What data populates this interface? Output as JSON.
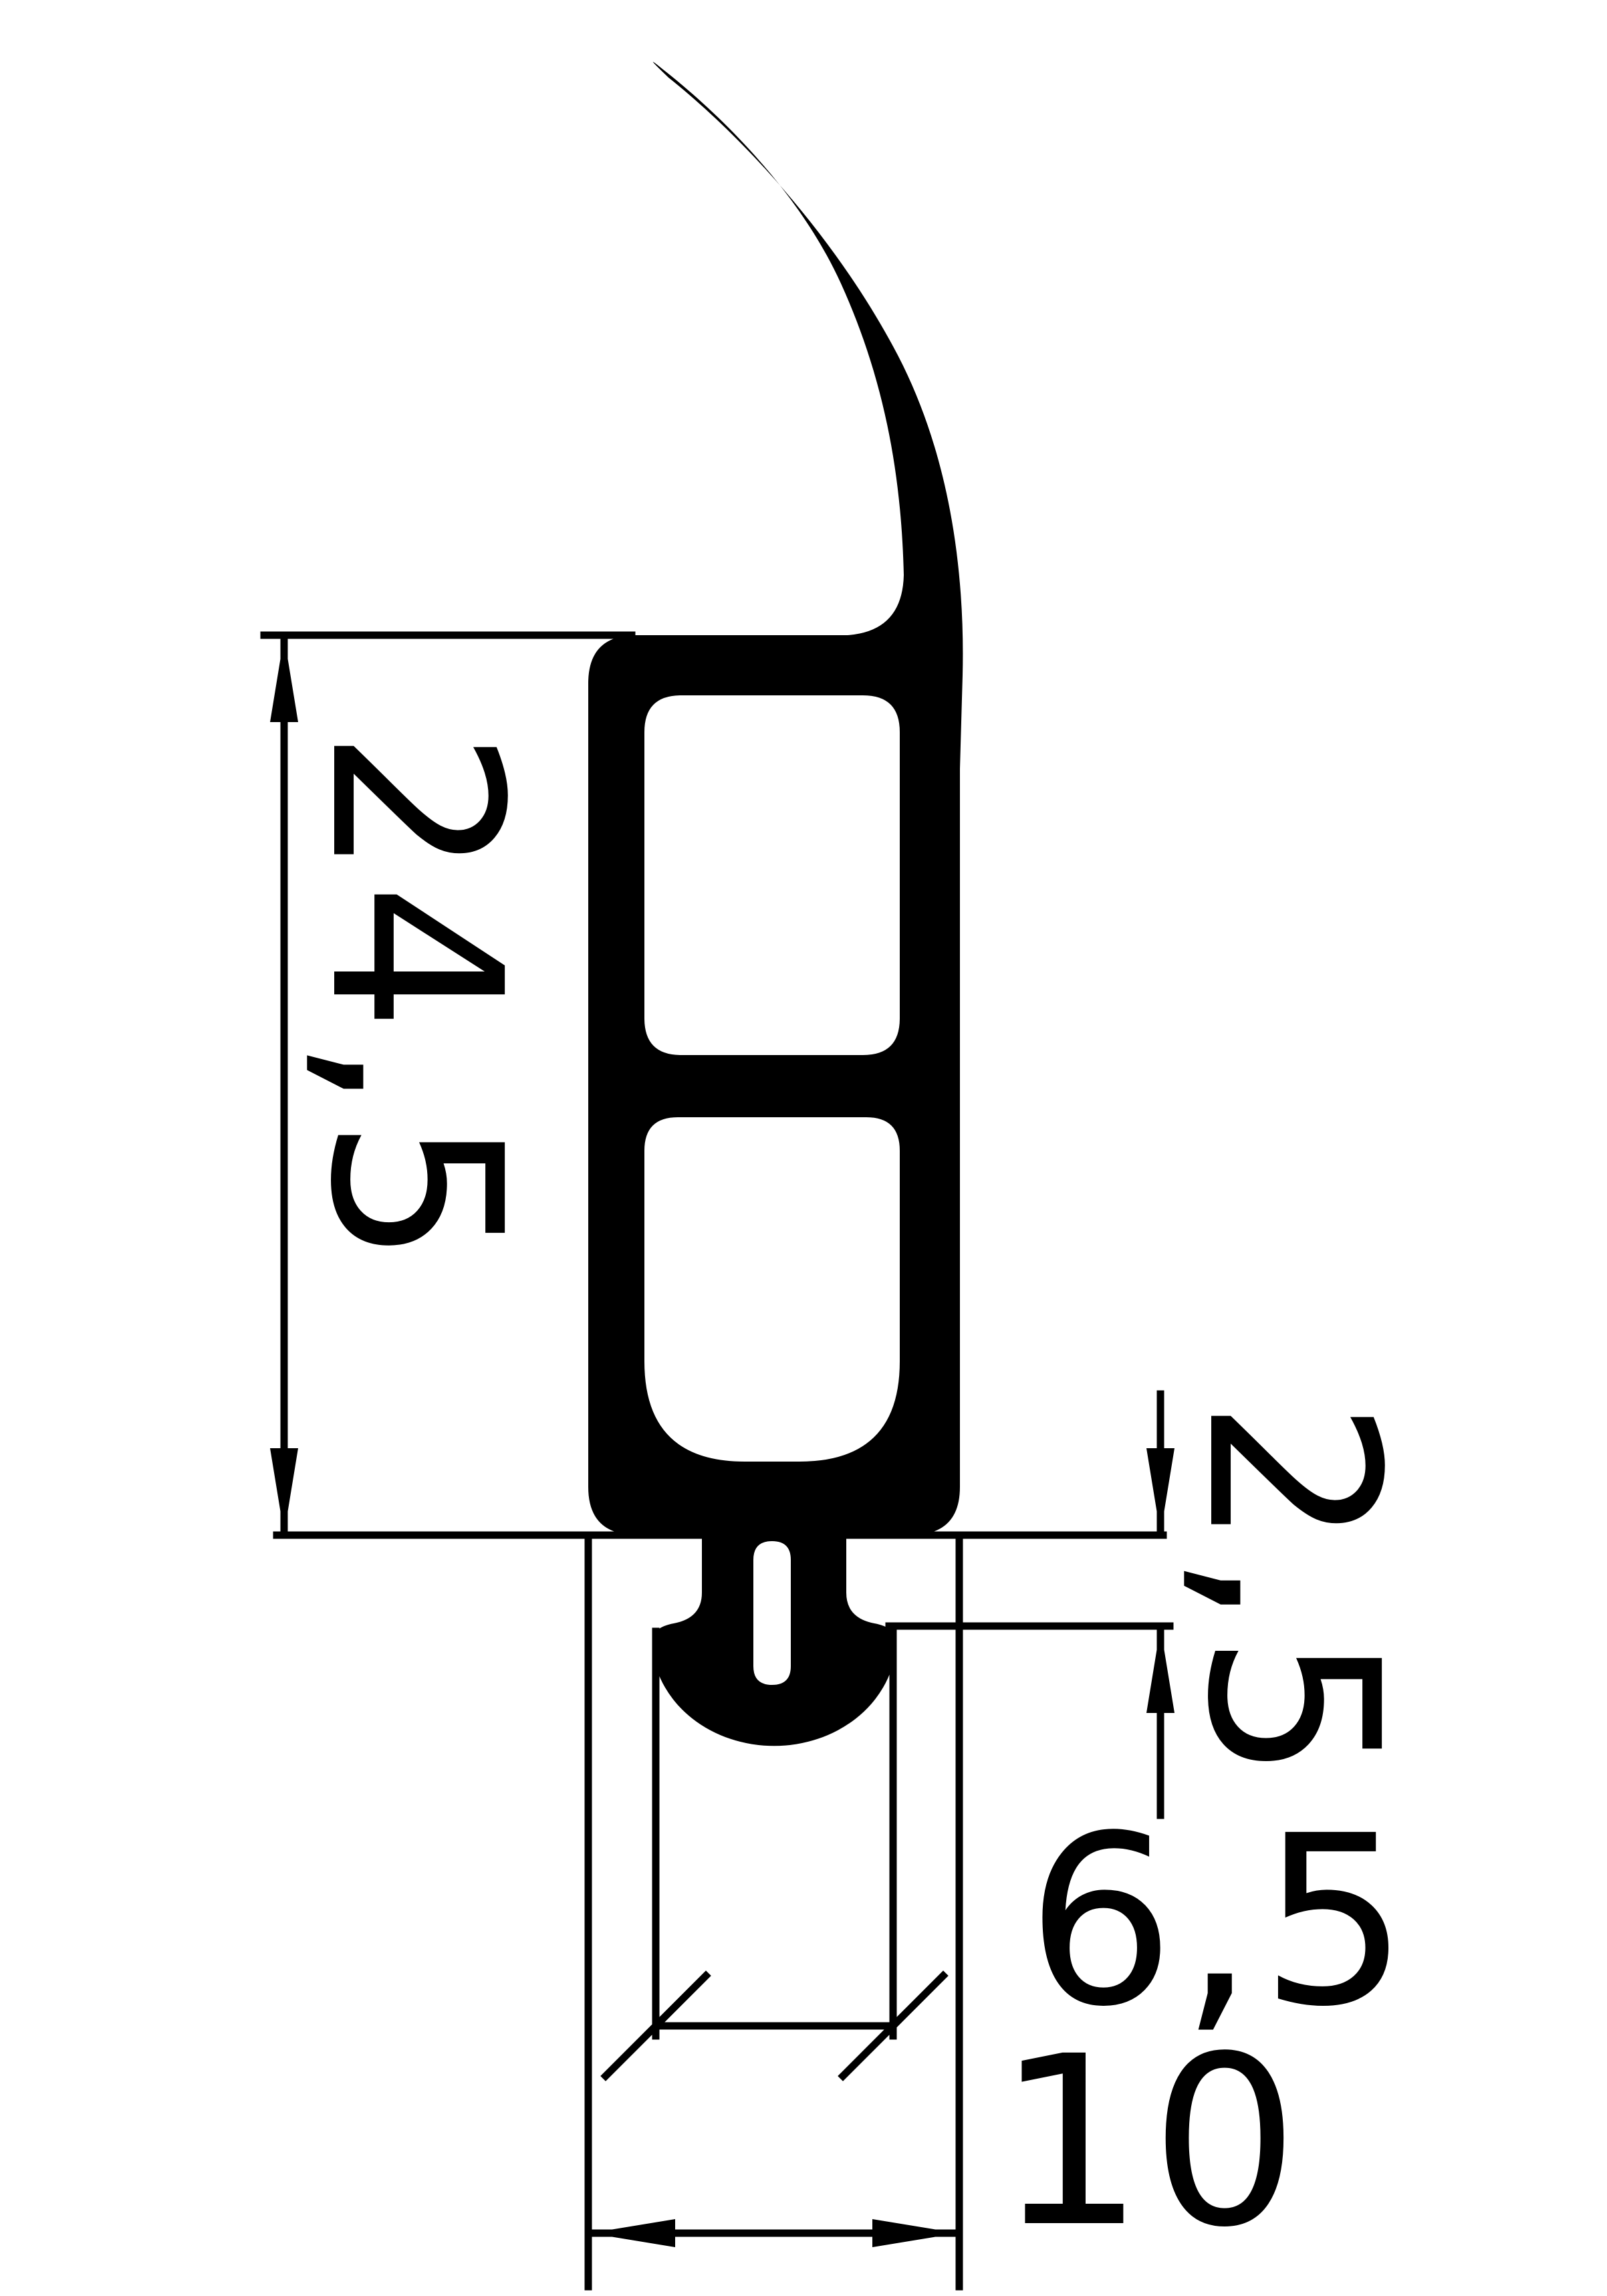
{
  "drawing": {
    "background_color": "#ffffff",
    "line_color": "#000000",
    "profile_fill_color": "#000000",
    "dimensions": {
      "profile_height_label": "24,5",
      "neck_height_label": "2,5",
      "flange_width_label": "6,5",
      "foot_width_label": "10"
    }
  }
}
